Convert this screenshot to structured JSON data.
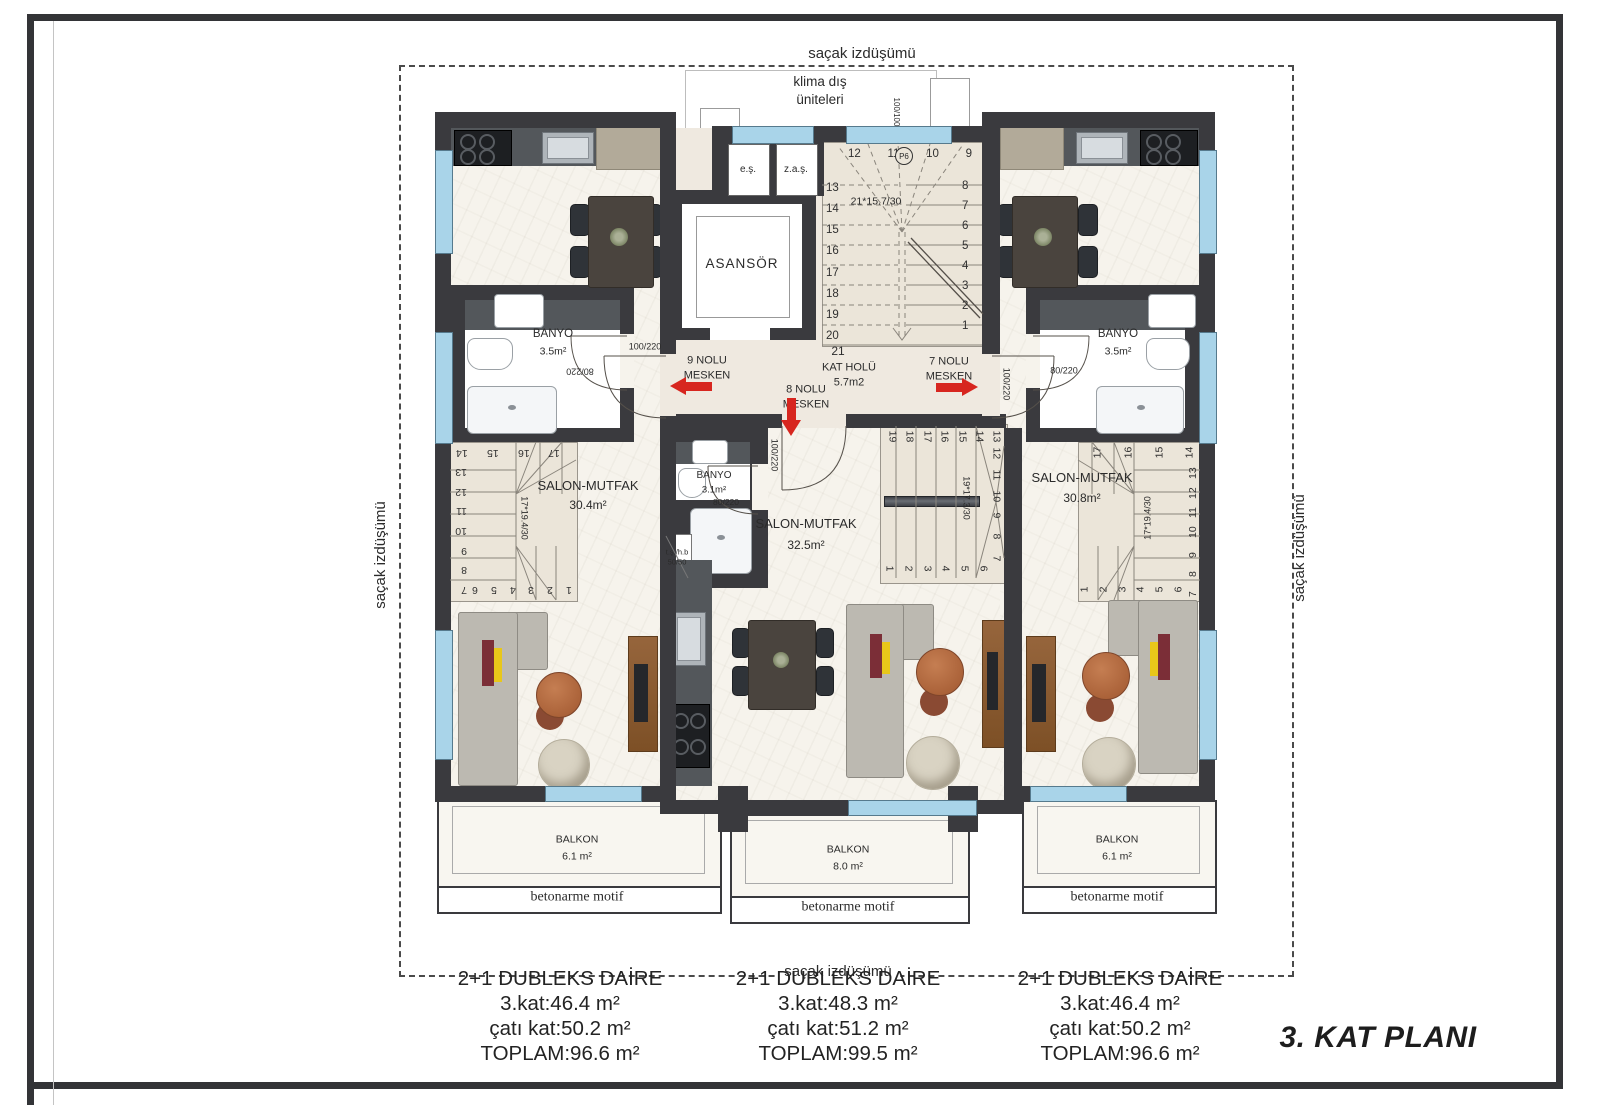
{
  "labels": {
    "eave": "saçak izdüşümü",
    "klima1": "klima dış",
    "klima2": "üniteleri",
    "title": "3. KAT PLANI"
  },
  "lobby": {
    "elevator": "ASANSÖR",
    "closet1": "e.ş.",
    "closet2": "z.a.ş.",
    "hall": "KAT HOLÜ",
    "hall_area": "5.7m2",
    "window_dim": "100/100",
    "marker": "P6",
    "stair": {
      "dim": "21*15.7/30",
      "top": [
        "12",
        "11",
        "10",
        "9"
      ],
      "left": [
        "13",
        "14",
        "15",
        "16",
        "17",
        "18",
        "19",
        "20"
      ],
      "right": [
        "8",
        "7",
        "6",
        "5",
        "4",
        "3",
        "2",
        "1"
      ],
      "last": "21"
    },
    "doors": {
      "u9": "100/220",
      "u7": "100/220",
      "u8": "100/220"
    }
  },
  "units": {
    "u9a": "9 NOLU",
    "u9b": "MESKEN",
    "u8a": "8 NOLU",
    "u8b": "MESKEN",
    "u7a": "7 NOLU",
    "u7b": "MESKEN"
  },
  "apartments": {
    "left": {
      "salon": "SALON-MUTFAK",
      "salon_area": "30.4m²",
      "bath": "BANYO",
      "bath_area": "3.5m²",
      "bath_door": "80/220",
      "stair": {
        "dim": "17*19.4/30",
        "top": [
          "14",
          "15",
          "16",
          "17"
        ],
        "side": [
          "13",
          "12",
          "11",
          "10",
          "9",
          "8",
          "7"
        ],
        "bottom": [
          "6",
          "5",
          "4",
          "3",
          "2",
          "1"
        ]
      },
      "balcony": "BALKON",
      "balcony_area": "6.1 m²",
      "motif": "betonarme motif",
      "info": [
        "2+1 DUBLEKS DAİRE",
        "3.kat:46.4 m²",
        "çatı kat:50.2 m²",
        "TOPLAM:96.6 m²"
      ]
    },
    "middle": {
      "salon": "SALON-MUTFAK",
      "salon_area": "32.5m²",
      "bath": "BANYO",
      "bath_area": "3.1m²",
      "bath_door": "80/220",
      "shaft1": "t.ş./h.b",
      "shaft2": "50/50",
      "stair": {
        "dim": "19*17.3/30",
        "top": [
          "19",
          "18",
          "17",
          "16",
          "15",
          "14",
          "13"
        ],
        "side": [
          "12",
          "11",
          "10",
          "9",
          "8",
          "7"
        ],
        "bottom": [
          "1",
          "2",
          "3",
          "4",
          "5",
          "6"
        ]
      },
      "balcony": "BALKON",
      "balcony_area": "8.0 m²",
      "motif": "betonarme motif",
      "info": [
        "2+1 DUBLEKS DAİRE",
        "3.kat:48.3 m²",
        "çatı kat:51.2 m²",
        "TOPLAM:99.5 m²"
      ]
    },
    "right": {
      "salon": "SALON-MUTFAK",
      "salon_area": "30.8m²",
      "bath": "BANYO",
      "bath_area": "3.5m²",
      "bath_door": "80/220",
      "stair": {
        "dim": "17*19.4/30",
        "top": [
          "17",
          "16",
          "15",
          "14"
        ],
        "side": [
          "13",
          "12",
          "11",
          "10",
          "9",
          "8",
          "7"
        ],
        "bottom": [
          "1",
          "2",
          "3",
          "4",
          "5",
          "6"
        ]
      },
      "balcony": "BALKON",
      "balcony_area": "6.1 m²",
      "motif": "betonarme motif",
      "info": [
        "2+1 DUBLEKS DAİRE",
        "3.kat:46.4 m²",
        "çatı kat:50.2 m²",
        "TOPLAM:96.6 m²"
      ]
    }
  },
  "colors": {
    "wall": "#3a3a3e",
    "window": "#a9d4e9",
    "arrow": "#d7261f",
    "wood": "#8a5a33",
    "counter": "#53575b"
  }
}
